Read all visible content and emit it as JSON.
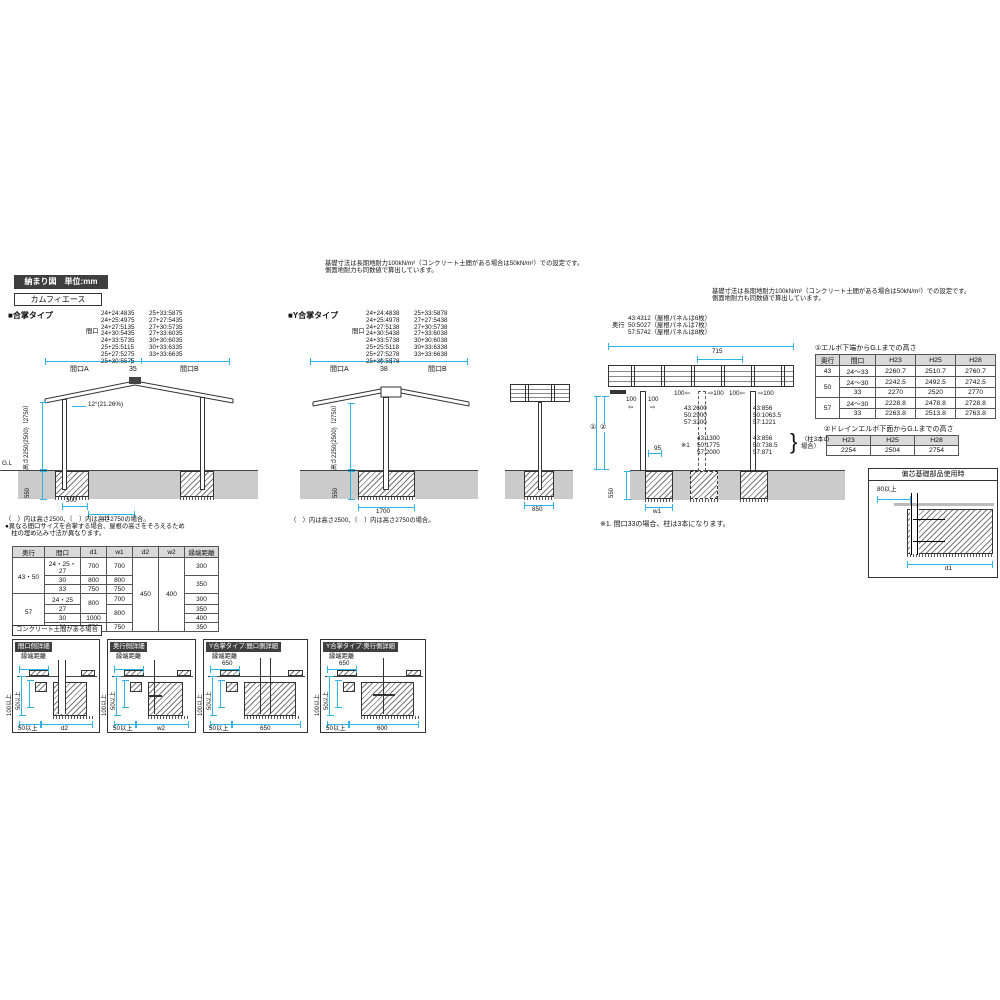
{
  "colors": {
    "accent": "#2eb3e8",
    "ground_band": "#cbcbcb",
    "title_bg": "#3f3f3f",
    "table_header_bg": "#d9d9d9"
  },
  "header": {
    "drawing_label": "納まり図　単位:mm",
    "product_name": "カムフィエース"
  },
  "foundation_note": [
    "基礎寸法は長期地耐力100kN/m²（コンクリート土間がある場合は50kN/m²）での設定です。",
    "側面地耐力も同数値で算出しています。"
  ],
  "gassho": {
    "title": "■合掌タイプ",
    "maguchi_label": "間口",
    "spec_col1": [
      "24+24:4835",
      "24+25:4975",
      "24+27:5135",
      "24+30:5435",
      "24+33:5735",
      "25+25:5115",
      "25+27:5275",
      "25+30:5575"
    ],
    "spec_col2": [
      "25+33:5875",
      "27+27:5435",
      "27+30:5735",
      "27+33:6035",
      "30+30:6035",
      "30+33:6335",
      "33+33:6635"
    ],
    "dim_a": "間口A",
    "dim_mid": "35",
    "dim_b": "間口B",
    "slope": "12°(21.26%)",
    "height_label": "高さ2250(2500)〔2750〕",
    "gl": "G.L",
    "depth": "550",
    "offset": "300",
    "d1": "d1",
    "notes": [
      "（　）内は高さ2500、〔　〕内は高さ2750の場合。",
      "●異なる間口サイズを合掌する場合、屋根の高さをそろえるため",
      "　柱の埋め込み寸法が異なります。"
    ]
  },
  "y_gassho": {
    "title": "■Y合掌タイプ",
    "maguchi_label": "間口",
    "spec_col1": [
      "24+24:4838",
      "24+25:4978",
      "24+27:5138",
      "24+30:5438",
      "24+33:5738",
      "25+25:5118",
      "25+27:5278",
      "25+30:5578"
    ],
    "spec_col2": [
      "25+33:5878",
      "27+27:5438",
      "27+30:5738",
      "27+33:6038",
      "30+30:6038",
      "30+33:6338",
      "33+33:6638"
    ],
    "dim_a": "間口A",
    "dim_mid": "38",
    "dim_b": "間口B",
    "height_label": "高さ2250(2500)〔2750〕",
    "depth": "550",
    "footing": "1700",
    "note": "（　）内は高さ2500、〔　〕内は高さ2750の場合。"
  },
  "side_view": {
    "footing": "850"
  },
  "main_table": {
    "headers": [
      "奥行",
      "間口",
      "d1",
      "w1",
      "d2",
      "w2",
      "縁端距離"
    ],
    "rows": [
      [
        "43・50",
        "24・25・27",
        "700",
        "700",
        "450",
        "400",
        "300"
      ],
      [
        "30",
        "800",
        "800",
        "350"
      ],
      [
        "33",
        "750",
        "750"
      ],
      [
        "57",
        "24・25",
        "800",
        "700",
        "300"
      ],
      [
        "27",
        "800",
        "350"
      ],
      [
        "30",
        "1000",
        "400"
      ],
      [
        "33",
        "750",
        "750",
        "350"
      ]
    ]
  },
  "concrete_label": "コンクリート土間がある場合",
  "detail_panels": [
    {
      "title": "間口側詳細",
      "edge_label": "縁端距離",
      "edge_value": "",
      "v1": "100以上",
      "v2": "50以上",
      "bottom1": "50以上",
      "bottom2": "d2"
    },
    {
      "title": "奥行側詳細",
      "edge_label": "縁端距離",
      "edge_value": "",
      "v1": "100以上",
      "v2": "50以上",
      "bottom1": "50以上",
      "bottom2": "w2"
    },
    {
      "title": "Y合掌タイプ:間口側詳細",
      "edge_label": "縁端距離",
      "edge_value": "650",
      "v1": "100以上",
      "v2": "50以上",
      "bottom1": "50以上",
      "bottom2": "650"
    },
    {
      "title": "Y合掌タイプ:奥行側詳細",
      "edge_label": "縁端距離",
      "edge_value": "650",
      "v1": "100以上",
      "v2": "50以上",
      "bottom1": "50以上",
      "bottom2": "600"
    }
  ],
  "right_view": {
    "okuyuki_label": "奥行",
    "spec": [
      "43:4312（屋根パネルは6枚）",
      "50:5027（屋根パネルは7枚）",
      "57:5742（屋根パネルは8枚）"
    ],
    "panel_pitch": "715",
    "a100l": "100",
    "a100r": "100",
    "arrow_l": "⇦",
    "arrow_r": "⇨",
    "mid_left": "100⇦",
    "mid_right": "⇨100",
    "r_left": "100⇦",
    "r_right": "⇨100",
    "block1": [
      "43:2600",
      "50:2900",
      "57:3300"
    ],
    "block1r": [
      "43:856",
      "50:1063.5",
      "57:1221"
    ],
    "ref_mark": "※1",
    "block2": [
      "43:1300",
      "50:1775",
      "57:2000"
    ],
    "block2r": [
      "43:856",
      "50:738.5",
      "57:871"
    ],
    "pillar_note": "（柱3本の場合）",
    "d95": "95",
    "w1": "w1",
    "depth": "550",
    "ref1": "①",
    "ref2": "②",
    "footnote": "※1. 間口33の場合、柱は3本になります。"
  },
  "elbow_table": {
    "title": "①エルボ下端からG.Lまでの高さ",
    "headers": [
      "奥行",
      "間口",
      "H23",
      "H25",
      "H28"
    ],
    "rows": [
      [
        "43",
        "24～33",
        "2260.7",
        "2510.7",
        "2760.7"
      ],
      [
        "50",
        "24～30",
        "2242.5",
        "2492.5",
        "2742.5"
      ],
      [
        "33",
        "2270",
        "2520",
        "2770"
      ],
      [
        "57",
        "24～30",
        "2228.8",
        "2478.8",
        "2728.8"
      ],
      [
        "33",
        "2263.8",
        "2513.8",
        "2763.8"
      ]
    ]
  },
  "drain_table": {
    "title": "②ドレインエルボ下面からG.Lまでの高さ",
    "headers": [
      "H23",
      "H25",
      "H28"
    ],
    "values": [
      "2254",
      "2504",
      "2754"
    ]
  },
  "henshin": {
    "title": "偏芯基礎部品使用時",
    "min80": "80以上",
    "d1": "d1"
  }
}
